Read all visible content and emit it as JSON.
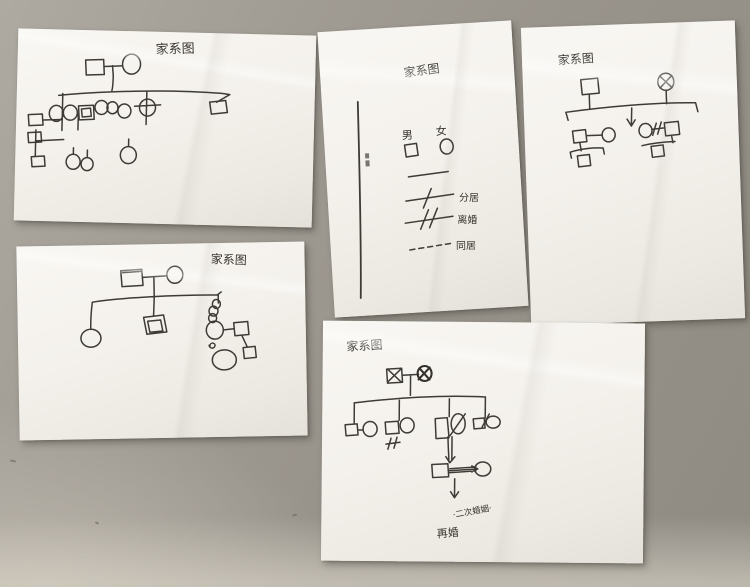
{
  "photo": {
    "description": "Five handwritten family genogram worksheets laid on a gray desk",
    "surface_color": "#98938b",
    "paper_color": "#f5f3ee",
    "ink_color": "#3e3b37"
  },
  "papers": {
    "top_left": {
      "title": "家系图"
    },
    "legend_sheet": {
      "title": "家系图",
      "legend": {
        "male_label": "男",
        "female_label": "女",
        "separated_label": "分居",
        "divorced_label": "离婚",
        "cohabiting_label": "同居"
      }
    },
    "top_right": {
      "title": "家系图"
    },
    "bottom_left": {
      "title": "家系图"
    },
    "bottom_center": {
      "title": "家系图",
      "note_line1": "·二次婚姻·",
      "note_line2": "再婚"
    }
  }
}
